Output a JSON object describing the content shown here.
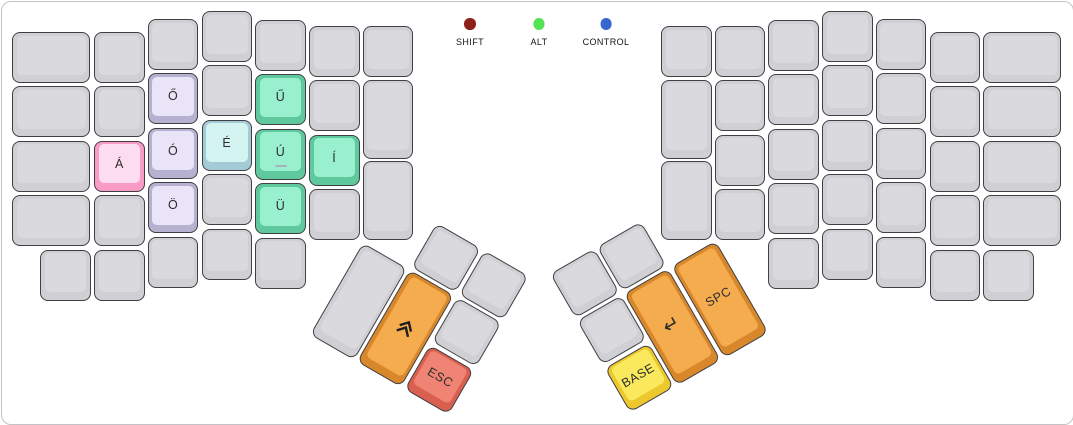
{
  "legend": {
    "items": [
      {
        "name": "shift",
        "label": "SHIFT",
        "color": "#8d2018"
      },
      {
        "name": "alt",
        "label": "ALT",
        "color": "#52e352"
      },
      {
        "name": "control",
        "label": "CONTROL",
        "color": "#3767ce"
      }
    ]
  },
  "palette": {
    "plain": {
      "ring": "#cfcfd4",
      "face": "#dadade"
    },
    "pink": {
      "ring": "#f89bc5",
      "face": "#fcdcef"
    },
    "lavender": {
      "ring": "#b7b1d0",
      "face": "#e9e4f7"
    },
    "cyan": {
      "ring": "#a4cad6",
      "face": "#d4f4f1"
    },
    "mint": {
      "ring": "#5fc99d",
      "face": "#99f0ce"
    },
    "orange": {
      "ring": "#d8882a",
      "face": "#f4ac4f"
    },
    "salmon": {
      "ring": "#d9604e",
      "face": "#f08474"
    },
    "yellow": {
      "ring": "#ecc72e",
      "face": "#fae95c"
    }
  },
  "keyboard": {
    "left_keys": [
      {
        "col": 1,
        "row": 2,
        "label": "Á",
        "color": "pink",
        "name": "key-a-acute"
      },
      {
        "col": 2,
        "row": 1,
        "label": "Ő",
        "color": "lavender",
        "name": "key-o-double-acute"
      },
      {
        "col": 2,
        "row": 2,
        "label": "Ó",
        "color": "lavender",
        "name": "key-o-acute"
      },
      {
        "col": 2,
        "row": 3,
        "label": "Ö",
        "color": "lavender",
        "name": "key-o-umlaut"
      },
      {
        "col": 3,
        "row": 2,
        "label": "É",
        "color": "cyan",
        "name": "key-e-acute"
      },
      {
        "col": 4,
        "row": 1,
        "label": "Ű",
        "color": "mint",
        "name": "key-u-double-acute"
      },
      {
        "col": 4,
        "row": 2,
        "label": "Ú",
        "color": "mint",
        "name": "key-u-acute",
        "sub": "_"
      },
      {
        "col": 4,
        "row": 3,
        "label": "Ü",
        "color": "mint",
        "name": "key-u-umlaut"
      },
      {
        "col": 5,
        "row": 2,
        "label": "Í",
        "color": "mint",
        "name": "key-i-acute"
      }
    ],
    "right_keys": [],
    "thumb_left": [
      {
        "slot": 3,
        "color": "orange",
        "icon": "chevron-double-up-icon",
        "name": "shift-key"
      },
      {
        "slot": 5,
        "color": "salmon",
        "label": "ESC",
        "name": "esc-key"
      }
    ],
    "thumb_right": [
      {
        "slot": 3,
        "color": "yellow",
        "label": "BASE",
        "name": "base-layer-key"
      },
      {
        "slot": 4,
        "color": "orange",
        "label": "↵",
        "name": "enter-key",
        "big": true
      },
      {
        "slot": 5,
        "color": "orange",
        "label": "SPC",
        "name": "space-key"
      }
    ]
  }
}
